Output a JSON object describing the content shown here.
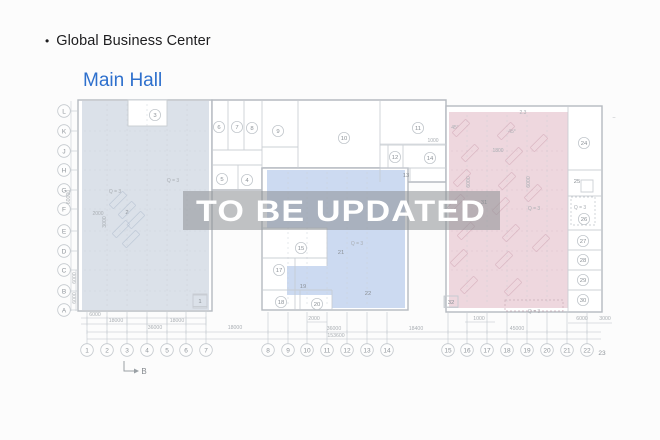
{
  "header": {
    "bullet": "•",
    "title": "Global Business Center",
    "subtitle": "Main Hall"
  },
  "watermark": {
    "text": "TO  BE UPDATED"
  },
  "colors": {
    "accent_blue": "#2e70cd",
    "title_text": "#1d1d1f",
    "zone_left": "#dbe1e9",
    "zone_middle": "#ccdaf1",
    "zone_right": "#eed7de",
    "watermark_band": "rgba(140,143,147,0.55)",
    "watermark_text": "#ffffff"
  },
  "plan": {
    "section_label": "B",
    "rows": [
      {
        "t": "L",
        "y": 111
      },
      {
        "t": "K",
        "y": 131
      },
      {
        "t": "J",
        "y": 151
      },
      {
        "t": "H",
        "y": 170
      },
      {
        "t": "G",
        "y": 190
      },
      {
        "t": "F",
        "y": 209
      },
      {
        "t": "E",
        "y": 231
      },
      {
        "t": "D",
        "y": 251
      },
      {
        "t": "C",
        "y": 270
      },
      {
        "t": "B",
        "y": 291
      },
      {
        "t": "A",
        "y": 310
      }
    ],
    "cols": [
      {
        "t": "1",
        "x": 87
      },
      {
        "t": "2",
        "x": 107
      },
      {
        "t": "3",
        "x": 127
      },
      {
        "t": "4",
        "x": 147
      },
      {
        "t": "5",
        "x": 167
      },
      {
        "t": "6",
        "x": 186
      },
      {
        "t": "7",
        "x": 206
      },
      {
        "t": "8",
        "x": 268
      },
      {
        "t": "9",
        "x": 288
      },
      {
        "t": "10",
        "x": 307
      },
      {
        "t": "11",
        "x": 327
      },
      {
        "t": "12",
        "x": 347
      },
      {
        "t": "13",
        "x": 367
      },
      {
        "t": "14",
        "x": 387
      },
      {
        "t": "15",
        "x": 448
      },
      {
        "t": "16",
        "x": 467
      },
      {
        "t": "17",
        "x": 487
      },
      {
        "t": "18",
        "x": 507
      },
      {
        "t": "19",
        "x": 527
      },
      {
        "t": "20",
        "x": 547
      },
      {
        "t": "21",
        "x": 567
      },
      {
        "t": "22",
        "x": 587
      },
      {
        "t": "23",
        "x": 602,
        "y": 353,
        "plain": true
      }
    ],
    "rooms": [
      {
        "n": "1",
        "x": 200,
        "y": 301,
        "sq": true
      },
      {
        "n": "2",
        "x": 127,
        "y": 212,
        "plain": true
      },
      {
        "n": "3",
        "x": 155,
        "y": 115
      },
      {
        "n": "4",
        "x": 247,
        "y": 180
      },
      {
        "n": "5",
        "x": 222,
        "y": 179
      },
      {
        "n": "6",
        "x": 219,
        "y": 127
      },
      {
        "n": "7",
        "x": 237,
        "y": 127
      },
      {
        "n": "8",
        "x": 252,
        "y": 128
      },
      {
        "n": "9",
        "x": 278,
        "y": 131
      },
      {
        "n": "10",
        "x": 344,
        "y": 138
      },
      {
        "n": "11",
        "x": 418,
        "y": 128
      },
      {
        "n": "12",
        "x": 395,
        "y": 157
      },
      {
        "n": "13",
        "x": 406,
        "y": 175,
        "plain": true
      },
      {
        "n": "14",
        "x": 430,
        "y": 158
      },
      {
        "n": "15",
        "x": 301,
        "y": 248
      },
      {
        "n": "17",
        "x": 279,
        "y": 270
      },
      {
        "n": "18",
        "x": 281,
        "y": 302
      },
      {
        "n": "19",
        "x": 303,
        "y": 286,
        "plain": true
      },
      {
        "n": "20",
        "x": 317,
        "y": 304
      },
      {
        "n": "21",
        "x": 341,
        "y": 252,
        "plain": true
      },
      {
        "n": "22",
        "x": 368,
        "y": 293,
        "plain": true
      },
      {
        "n": "24",
        "x": 584,
        "y": 143
      },
      {
        "n": "25",
        "x": 577,
        "y": 181,
        "plain": true
      },
      {
        "n": "26",
        "x": 584,
        "y": 219
      },
      {
        "n": "27",
        "x": 583,
        "y": 241
      },
      {
        "n": "28",
        "x": 583,
        "y": 260
      },
      {
        "n": "29",
        "x": 583,
        "y": 280
      },
      {
        "n": "30",
        "x": 583,
        "y": 300
      },
      {
        "n": "31",
        "x": 484,
        "y": 202,
        "plain": true
      },
      {
        "n": "32",
        "x": 451,
        "y": 302,
        "sq": true
      }
    ],
    "notes": [
      {
        "t": "Q = 3",
        "x": 173,
        "y": 182
      },
      {
        "t": "Q = 3",
        "x": 115,
        "y": 193
      },
      {
        "t": "Q = 3",
        "x": 357,
        "y": 245
      },
      {
        "t": "Q = 3",
        "x": 534,
        "y": 210
      },
      {
        "t": "Q = 3",
        "x": 580,
        "y": 209
      },
      {
        "t": "Q = 3",
        "x": 534,
        "y": 313
      },
      {
        "t": "45°",
        "x": 455,
        "y": 129
      },
      {
        "t": "45°",
        "x": 512,
        "y": 133
      },
      {
        "t": "1800",
        "x": 498,
        "y": 152
      },
      {
        "t": "2000",
        "x": 98,
        "y": 215
      },
      {
        "t": "2.3",
        "x": 523,
        "y": 114
      },
      {
        "t": "1000",
        "x": 433,
        "y": 142
      },
      {
        "t": "–",
        "x": 614,
        "y": 119
      }
    ],
    "dims": [
      {
        "t": "6000",
        "x": 95,
        "y": 316
      },
      {
        "t": "18000",
        "x": 116,
        "y": 322
      },
      {
        "t": "18000",
        "x": 177,
        "y": 322
      },
      {
        "t": "36000",
        "x": 155,
        "y": 329
      },
      {
        "t": "18000",
        "x": 235,
        "y": 329
      },
      {
        "t": "2000",
        "x": 314,
        "y": 320
      },
      {
        "t": "36000",
        "x": 334,
        "y": 330
      },
      {
        "t": "18400",
        "x": 416,
        "y": 330
      },
      {
        "t": "45000",
        "x": 517,
        "y": 330
      },
      {
        "t": "153600",
        "x": 336,
        "y": 337
      },
      {
        "t": "1000",
        "x": 479,
        "y": 320
      },
      {
        "t": "6000",
        "x": 582,
        "y": 320
      },
      {
        "t": "3000",
        "x": 605,
        "y": 320
      }
    ],
    "vdims": [
      {
        "t": "60000",
        "x": 70,
        "y": 197
      },
      {
        "t": "6000",
        "x": 76,
        "y": 278
      },
      {
        "t": "6000",
        "x": 76,
        "y": 298
      },
      {
        "t": "3000",
        "x": 106,
        "y": 222
      },
      {
        "t": "6000",
        "x": 470,
        "y": 182
      },
      {
        "t": "6000",
        "x": 530,
        "y": 182
      }
    ],
    "hatches": {
      "left": [
        [
          118,
          200
        ],
        [
          127,
          210
        ],
        [
          136,
          220
        ],
        [
          121,
          229
        ],
        [
          131,
          239
        ]
      ],
      "pink": [
        [
          461,
          128
        ],
        [
          470,
          153
        ],
        [
          462,
          178
        ],
        [
          456,
          203
        ],
        [
          466,
          231
        ],
        [
          459,
          258
        ],
        [
          469,
          285
        ],
        [
          506,
          131
        ],
        [
          514,
          156
        ],
        [
          507,
          181
        ],
        [
          501,
          206
        ],
        [
          511,
          233
        ],
        [
          504,
          260
        ],
        [
          513,
          287
        ],
        [
          539,
          143
        ],
        [
          533,
          193
        ],
        [
          541,
          243
        ]
      ]
    }
  }
}
